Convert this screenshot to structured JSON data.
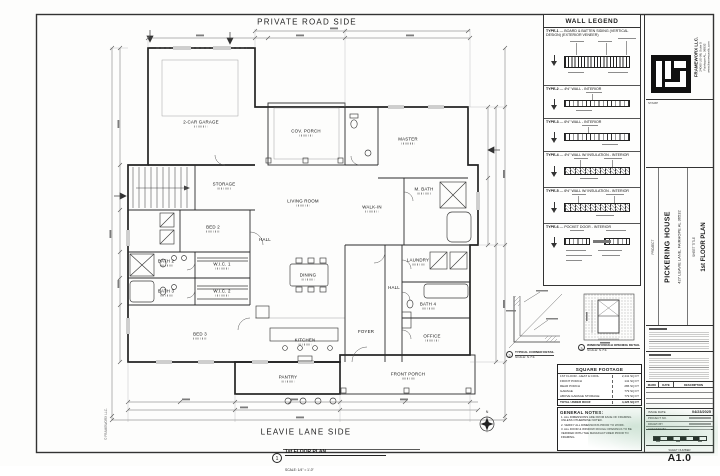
{
  "sheet": {
    "side_label_top": "PRIVATE ROAD SIDE",
    "side_label_bottom": "LEAVIE LANE SIDE",
    "north_label": "N",
    "edge_stamp": "© FRAMEWORX LLC.",
    "drawing_callout": {
      "number": "1",
      "title": "1st FLOOR PLAN",
      "scale": "SCALE: 1/4\" = 1'-0\""
    }
  },
  "plan": {
    "rooms": [
      {
        "label": "2-CAR GARAGE"
      },
      {
        "label": "STORAGE"
      },
      {
        "label": "COV. PORCH"
      },
      {
        "label": "MASTER"
      },
      {
        "label": "LIVING ROOM"
      },
      {
        "label": "BED 2"
      },
      {
        "label": "HALL"
      },
      {
        "label": "DINING"
      },
      {
        "label": "WALK-IN"
      },
      {
        "label": "M. BATH"
      },
      {
        "label": "LAUNDRY"
      },
      {
        "label": "BATH 2"
      },
      {
        "label": "BATH 3"
      },
      {
        "label": "W.I.C. 1"
      },
      {
        "label": "W.I.C. 2"
      },
      {
        "label": "BED 3"
      },
      {
        "label": "KITCHEN"
      },
      {
        "label": "PANTRY"
      },
      {
        "label": "FOYER"
      },
      {
        "label": "HALL"
      },
      {
        "label": "BATH 4"
      },
      {
        "label": "OFFICE"
      },
      {
        "label": "FRONT PORCH"
      }
    ]
  },
  "wall_legend": {
    "title": "WALL LEGEND",
    "types": [
      {
        "label": "TYPE-1",
        "desc": "BOARD & BATTEN SIDING (VERTICAL DESIGN) (EXTERIOR VENEER)"
      },
      {
        "label": "TYPE-2",
        "desc": "4½\" WALL - INTERIOR"
      },
      {
        "label": "TYPE-3",
        "desc": "6½\" WALL - INTERIOR"
      },
      {
        "label": "TYPE-4",
        "desc": "4½\" WALL W/ INSULATION - INTERIOR"
      },
      {
        "label": "TYPE-5",
        "desc": "6½\" WALL W/ INSULATION - INTERIOR"
      },
      {
        "label": "TYPE-6",
        "desc": "POCKET DOOR - INTERIOR"
      }
    ]
  },
  "details": [
    {
      "number": "2",
      "title": "TYPICAL CORNER DETAIL",
      "scale": "SCALE: N.T.S."
    },
    {
      "number": "3",
      "title": "WINDOW ROUGH OPENING DETAIL",
      "scale": "SCALE: N.T.S."
    }
  ],
  "square_footage": {
    "title": "SQUARE FOOTAGE",
    "rows": [
      {
        "label": "1ST FLOOR - HEAT & COOL",
        "value": "2,441 SQ FT"
      },
      {
        "label": "FRONT PORCH",
        "value": "141 SQ FT"
      },
      {
        "label": "REAR PORCH",
        "value": "286 SQ FT"
      },
      {
        "label": "GARAGE",
        "value": "779 SQ FT"
      },
      {
        "label": "ABOVE GARAGE STORAGE",
        "value": "779 SQ FT"
      }
    ],
    "total": {
      "label": "TOTAL UNDER ROOF",
      "value": "4,426 SQ FT"
    }
  },
  "general_notes": {
    "title": "GENERAL NOTES:",
    "notes": [
      "1.  ALL DIMENSIONS ARE FROM FACE OF FRAMING UNLESS OTHERWISE NOTED.",
      "2.  VERIFY ALL DIMENSIONS PRIOR TO WORK.",
      "3.  ALL DOOR & WINDOW ROUGH OPENINGS TO BE VERIFIED WITH THE MANUFACTURER PRIOR TO FRAMING."
    ]
  },
  "title_block": {
    "company": {
      "name": "FRAMEWORX LLC.",
      "address1": "24060 US-98, Suite 5",
      "address2": "Fairhope AL, 36532",
      "website": "www.frameworxllc.com"
    },
    "stamp_label": "STAMP",
    "project_label": "PROJECT",
    "project_name": "PICKERING HOUSE",
    "project_address": "427 LEAVIE LANE,  FAIRHOPE AL 36532",
    "sheet_title_label": "SHEET TITLE",
    "sheet_title": "1st FLOOR PLAN",
    "revisions": {
      "headers": [
        "MARK",
        "DATE",
        "DESCRIPTION"
      ]
    },
    "issue_date_label": "ISSUE DATE",
    "issue_date": "04/23/2025",
    "fields": [
      {
        "label": "PROJECT NO."
      },
      {
        "label": "DRAWN BY"
      },
      {
        "label": "CHECKED BY"
      }
    ],
    "sheet_number_label": "SHEET NUMBER",
    "sheet_number": "A1.0"
  }
}
